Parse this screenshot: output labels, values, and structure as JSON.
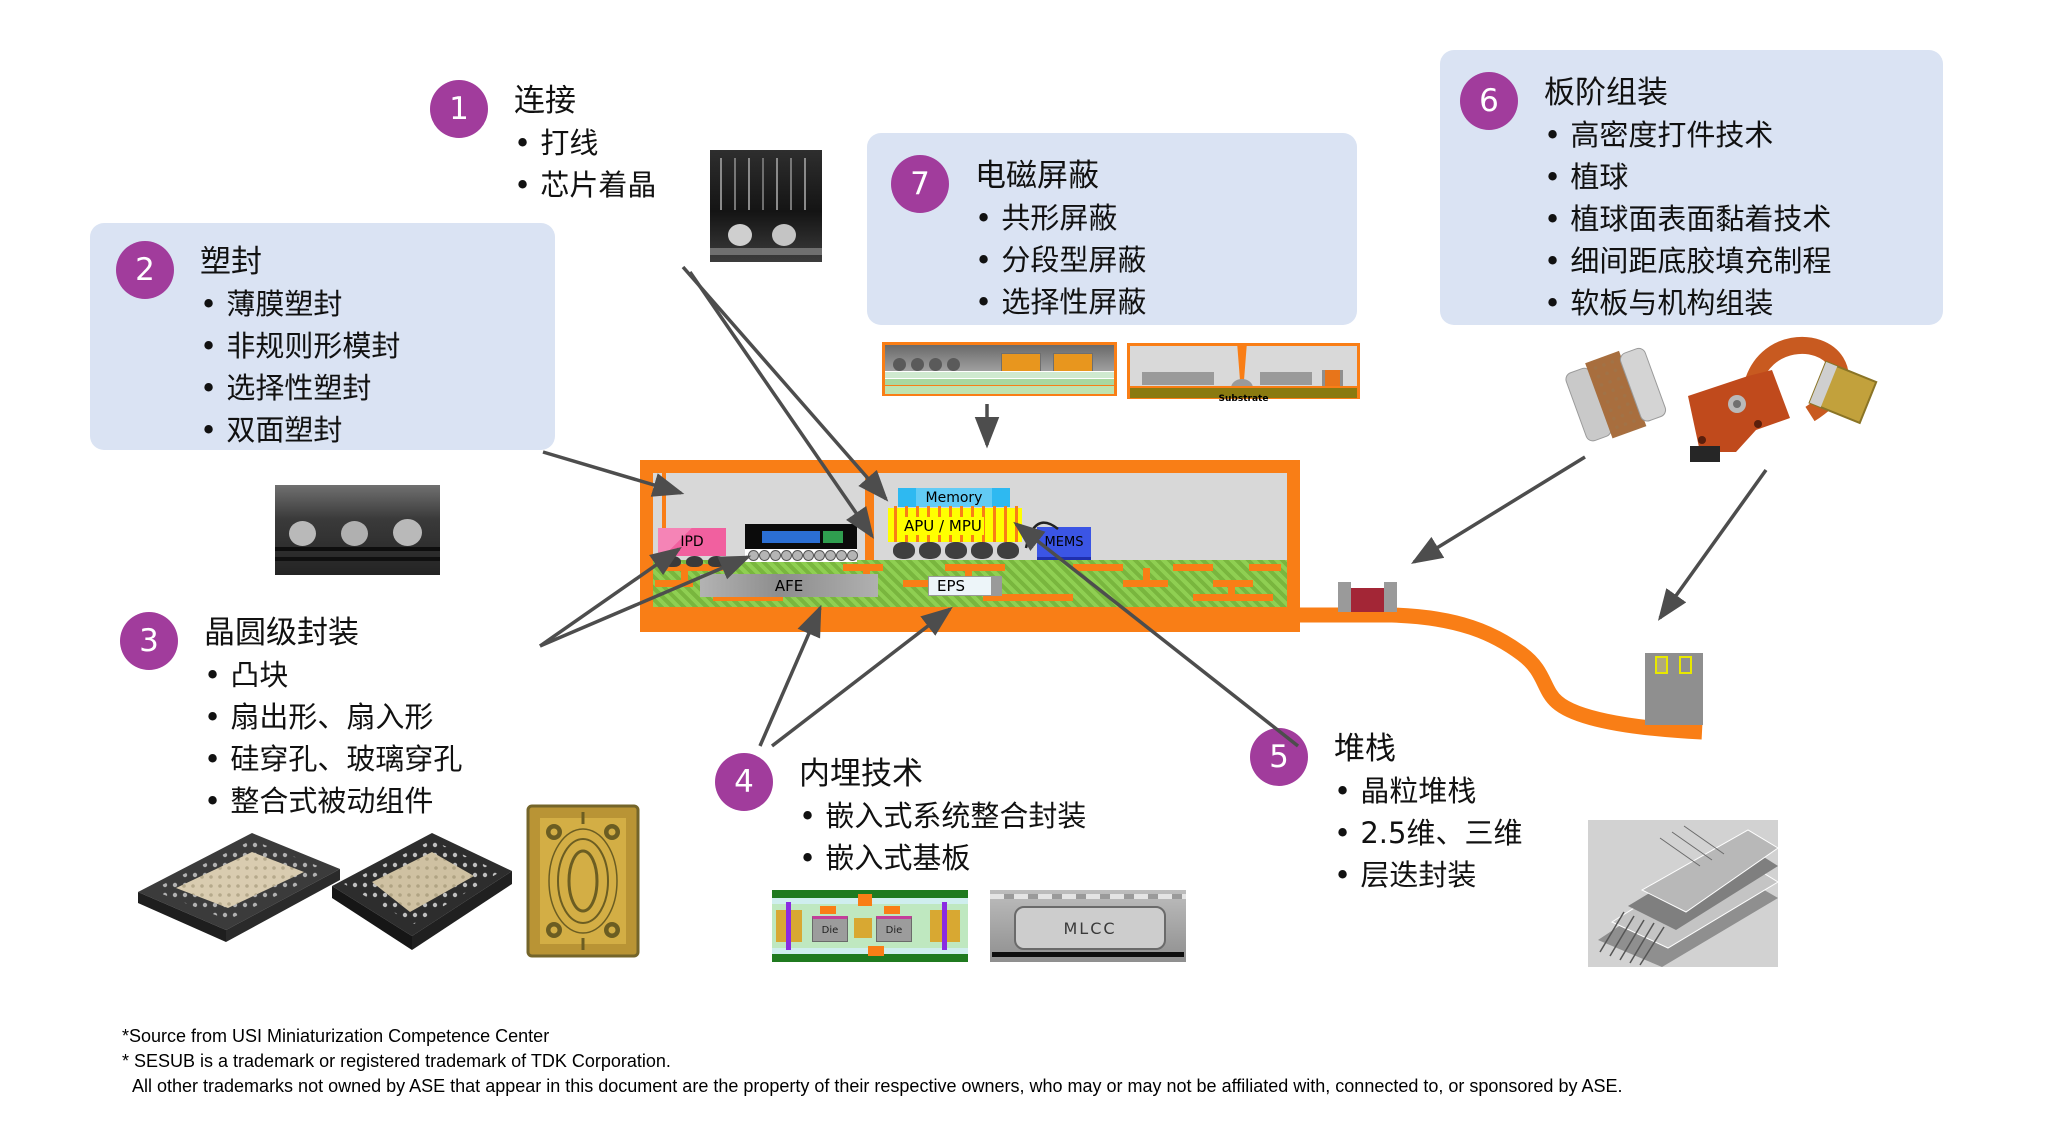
{
  "colors": {
    "accent_purple": "#A13C9C",
    "callout_box_blue": "#DAE3F3",
    "shield_orange": "#F97E16",
    "substrate_green": "#8FCF52",
    "arrow_gray": "#4d4d4d"
  },
  "callouts": [
    {
      "number": "1",
      "title": "连接",
      "bullets": [
        "打线",
        "芯片着晶"
      ]
    },
    {
      "number": "2",
      "title": "塑封",
      "bullets": [
        "薄膜塑封",
        "非规则形模封",
        "选择性塑封",
        "双面塑封"
      ]
    },
    {
      "number": "3",
      "title": "晶圆级封装",
      "bullets": [
        "凸块",
        "扇出形、扇入形",
        "硅穿孔、玻璃穿孔",
        "整合式被动组件"
      ]
    },
    {
      "number": "4",
      "title": "内埋技术",
      "bullets": [
        "嵌入式系统整合封装",
        "嵌入式基板"
      ]
    },
    {
      "number": "5",
      "title": "堆栈",
      "bullets": [
        "晶粒堆栈",
        "2.5维、三维",
        "层迭封装"
      ]
    },
    {
      "number": "6",
      "title": "板阶组装",
      "bullets": [
        "高密度打件技术",
        "植球",
        "植球面表面黏着技术",
        "细间距底胶填充制程",
        "软板与机构组装"
      ]
    },
    {
      "number": "7",
      "title": "电磁屏蔽",
      "bullets": [
        "共形屏蔽",
        "分段型屏蔽",
        "选择性屏蔽"
      ]
    }
  ],
  "diagram": {
    "labels": {
      "ipd": "IPD",
      "afe": "AFE",
      "eps": "EPS",
      "memory": "Memory",
      "apu": "APU / MPU",
      "mems": "MEMS",
      "substrate": "Substrate",
      "die1": "Die",
      "die2": "Die",
      "mlcc": "MLCC"
    }
  },
  "footer": {
    "line1": "*Source from USI Miniaturization Competence Center",
    "line2": "* SESUB is a trademark or registered trademark of TDK Corporation.",
    "line3": "All other trademarks not owned by ASE that appear in this document are the property of their respective owners, who may or may not be affiliated with, connected to, or sponsored by ASE."
  }
}
